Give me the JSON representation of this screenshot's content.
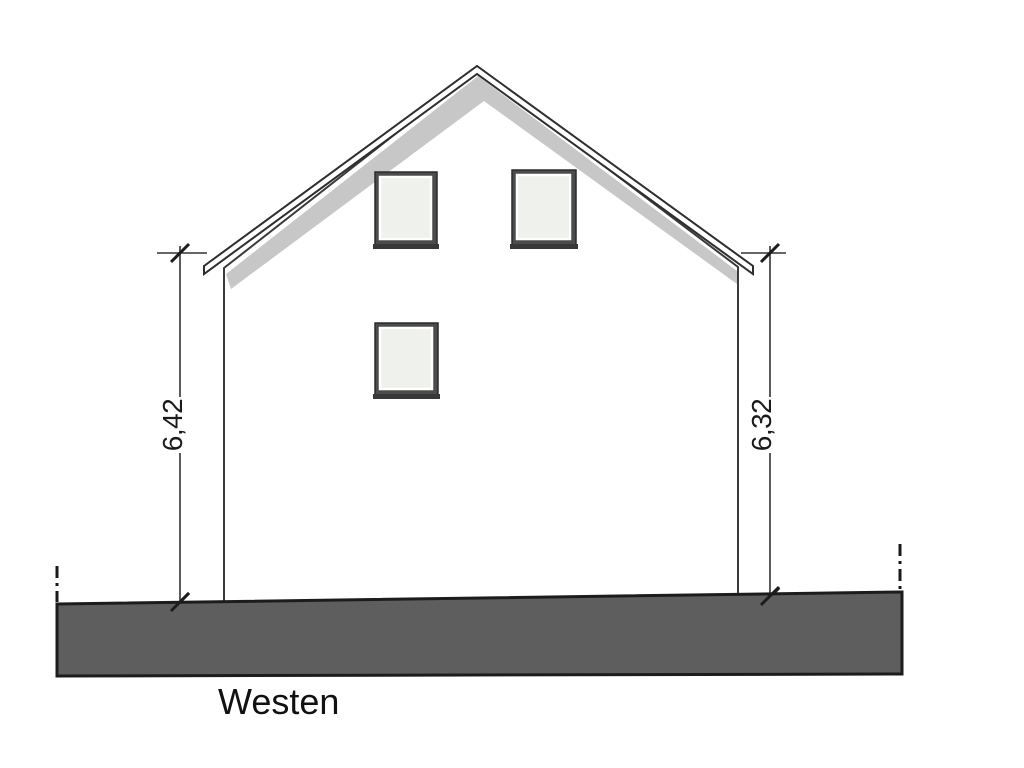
{
  "drawing": {
    "elevation_label": "Westen",
    "dimensions": {
      "left_height": "6,42",
      "right_height": "6,32"
    },
    "colors": {
      "background": "#ffffff",
      "shadow": "#c7c7c7",
      "ground": "#5e5e5e",
      "frame": "#4c4c4c",
      "glass": "#eef1ec"
    }
  }
}
